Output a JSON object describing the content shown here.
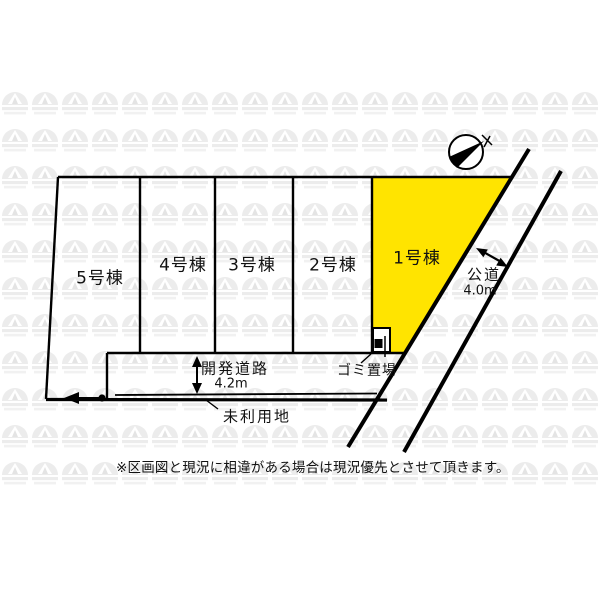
{
  "map_type": "区画図",
  "parcels": [
    {
      "label": "5号棟",
      "highlighted": false
    },
    {
      "label": "4号棟",
      "highlighted": false
    },
    {
      "label": "3号棟",
      "highlighted": false
    },
    {
      "label": "2号棟",
      "highlighted": false
    },
    {
      "label": "1号棟",
      "highlighted": true
    }
  ],
  "roads": {
    "public_road": {
      "label": "公道",
      "width": "4.0m"
    },
    "development_road": {
      "label": "開発道路",
      "width": "4.2m"
    }
  },
  "annotations": {
    "garbage_area": "ゴミ置場",
    "unused_land": "未利用地",
    "disclaimer": "※区画図と現況に相違がある場合は現況優先とさせて頂きます。"
  },
  "colors": {
    "highlight": "#ffe400",
    "line": "#000000",
    "watermark": "#ececec",
    "background": "#ffffff"
  }
}
